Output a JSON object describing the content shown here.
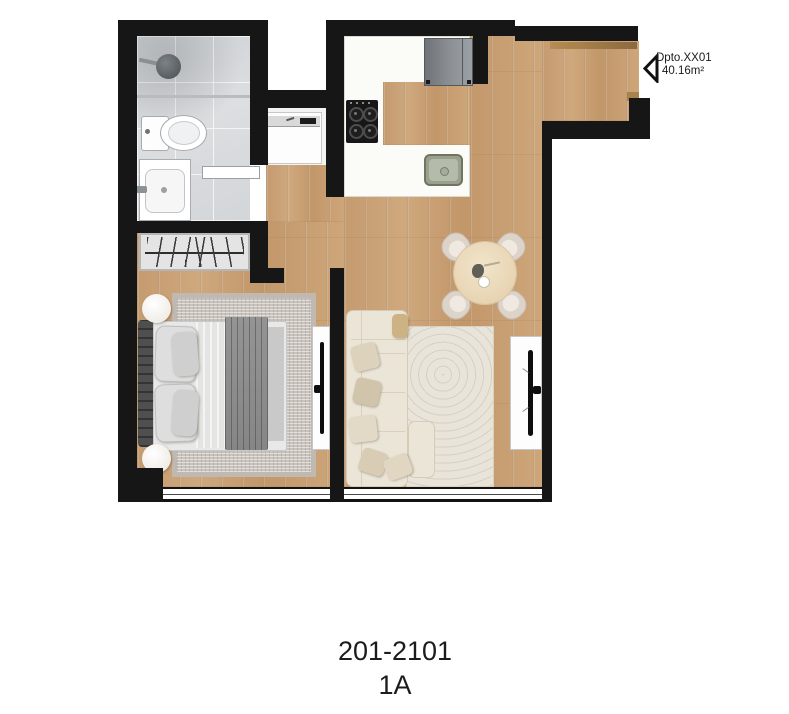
{
  "labels": {
    "unit": "Dpto.XX01",
    "area": "40.16m²",
    "plan_number": "201-2101",
    "plan_variant": "1A"
  },
  "colors": {
    "wall": "#161616",
    "wood_floor": "#c7a077",
    "bathroom_tile": "#d7d9db",
    "counter": "#fbfbf8",
    "entry_door": "#a9824b",
    "sofa": "#ebe5d8",
    "bed_blanket": "#8d8d8d",
    "living_rug": "#e9e4d9",
    "bedroom_rug": "#c9c3bd",
    "kitchen_sink": "#99a08c",
    "fridge": "#84888c",
    "text": "#1b1b1b"
  }
}
